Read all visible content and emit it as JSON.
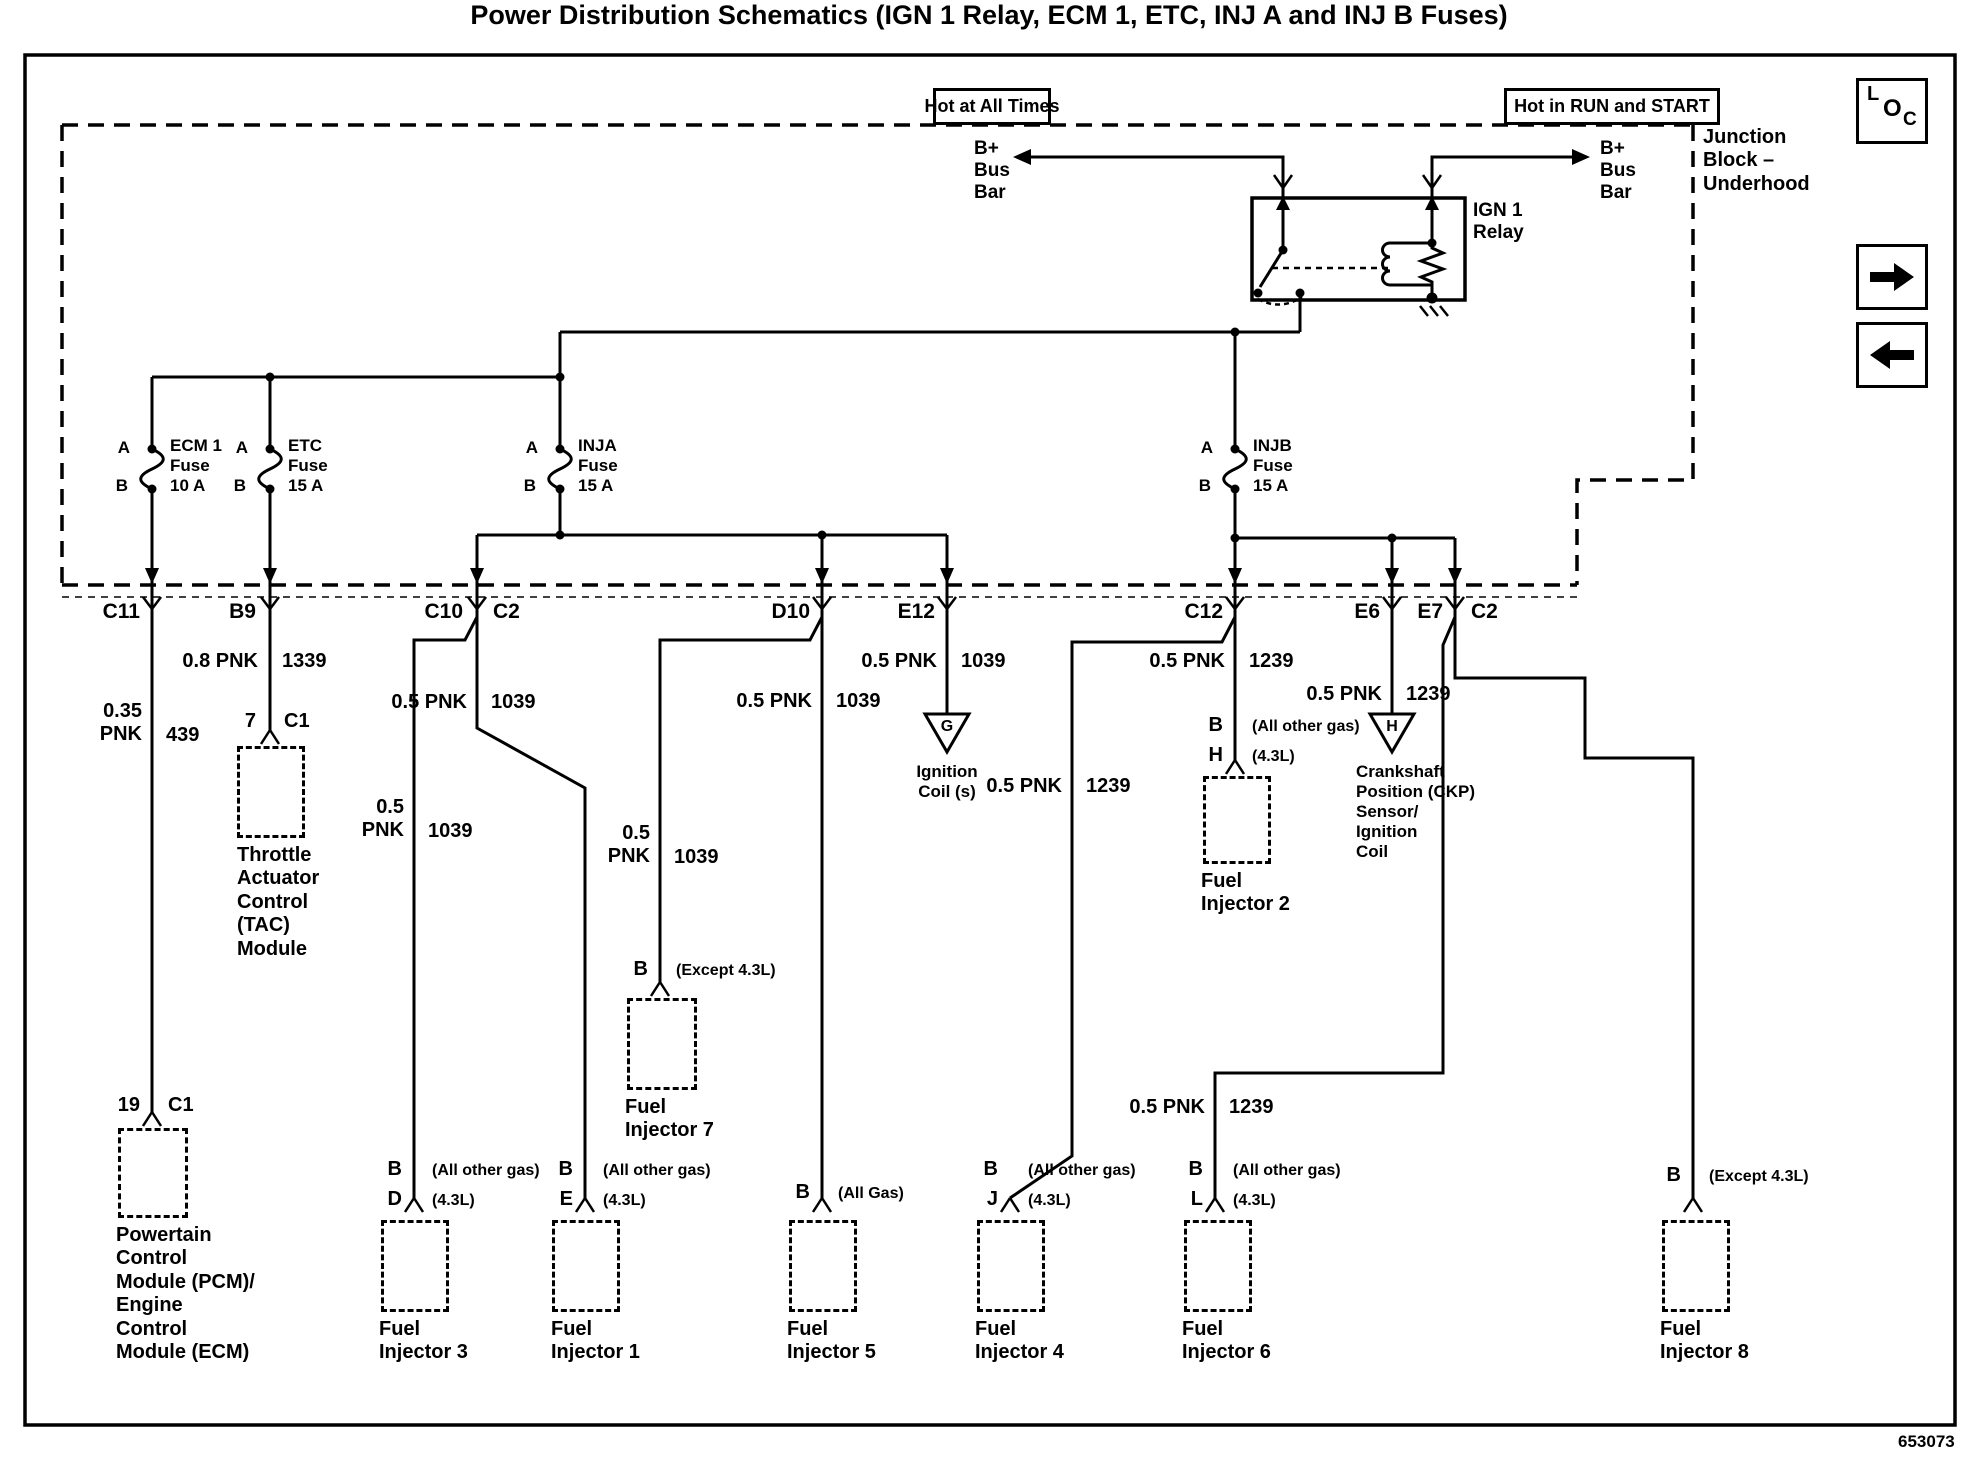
{
  "title": "Power Distribution Schematics (IGN 1 Relay, ECM 1, ETC, INJ A and INJ B Fuses)",
  "doc_number": "653073",
  "banners": {
    "left": "Hot at All Times",
    "right": "Hot in RUN and START"
  },
  "junction_block": {
    "label": "Junction\nBlock –\nUnderhood"
  },
  "loc_icon": {
    "l": "L",
    "o": "O",
    "c": "C"
  },
  "bus_bar_left": "B+\nBus\nBar",
  "bus_bar_right": "B+\nBus\nBar",
  "relay_label": "IGN 1\nRelay",
  "fuses": [
    {
      "pin_top": "A",
      "pin_bottom": "B",
      "name": "ECM 1\nFuse\n10 A"
    },
    {
      "pin_top": "A",
      "pin_bottom": "B",
      "name": "ETC\nFuse\n15 A"
    },
    {
      "pin_top": "A",
      "pin_bottom": "B",
      "name": "INJA\nFuse\n15 A"
    },
    {
      "pin_top": "A",
      "pin_bottom": "B",
      "name": "INJB\nFuse\n15 A"
    }
  ],
  "connectors": {
    "c11": "C11",
    "b9": "B9",
    "c10": "C10",
    "c10_right": "C2",
    "d10": "D10",
    "e12": "E12",
    "c12": "C12",
    "e6": "E6",
    "e7": "E7",
    "e7_right": "C2"
  },
  "wires": {
    "c11": {
      "gauge": "0.35\nPNK",
      "circuit": "439"
    },
    "b9": {
      "gauge": "0.8 PNK",
      "circuit": "1339"
    },
    "c2_main": {
      "gauge": "0.5 PNK",
      "circuit": "1039"
    },
    "fi3": {
      "gauge": "0.5\nPNK",
      "circuit": "1039"
    },
    "fi7": {
      "gauge": "0.5\nPNK",
      "circuit": "1039"
    },
    "d10": {
      "gauge": "0.5 PNK",
      "circuit": "1039"
    },
    "e12": {
      "gauge": "0.5 PNK",
      "circuit": "1039"
    },
    "c12": {
      "gauge": "0.5 PNK",
      "circuit": "1239"
    },
    "fi4": {
      "gauge": "0.5 PNK",
      "circuit": "1239"
    },
    "e6": {
      "gauge": "0.5 PNK",
      "circuit": "1239"
    },
    "fi6": {
      "gauge": "0.5 PNK",
      "circuit": "1239"
    }
  },
  "devices": {
    "tac": {
      "pin": "7",
      "conn": "C1",
      "name": "Throttle\nActuator\nControl\n(TAC)\nModule"
    },
    "pcm": {
      "pin": "19",
      "conn": "C1",
      "name": "Powertain\nControl\nModule (PCM)/\nEngine\nControl\nModule (ECM)"
    },
    "ign_coil": {
      "letter": "G",
      "name": "Ignition\nCoil (s)"
    },
    "ckp": {
      "letter": "H",
      "name": "Crankshaft\nPosition (CKP)\nSensor/\nIgnition\nCoil"
    },
    "fi1": {
      "pin1": "B",
      "qual1": "(All other gas)",
      "pin2": "E",
      "qual2": "(4.3L)",
      "name": "Fuel\nInjector 1"
    },
    "fi2": {
      "pin1": "B",
      "qual1": "(All other gas)",
      "pin2": "H",
      "qual2": "(4.3L)",
      "name": "Fuel\nInjector 2"
    },
    "fi3": {
      "pin1": "B",
      "qual1": "(All other gas)",
      "pin2": "D",
      "qual2": "(4.3L)",
      "name": "Fuel\nInjector 3"
    },
    "fi4": {
      "pin1": "B",
      "qual1": "(All other gas)",
      "pin2": "J",
      "qual2": "(4.3L)",
      "name": "Fuel\nInjector 4"
    },
    "fi5": {
      "pin1": "B",
      "qual1": "(All Gas)",
      "name": "Fuel\nInjector 5"
    },
    "fi6": {
      "pin1": "B",
      "qual1": "(All other gas)",
      "pin2": "L",
      "qual2": "(4.3L)",
      "name": "Fuel\nInjector 6"
    },
    "fi7": {
      "pin1": "B",
      "qual1": "(Except 4.3L)",
      "name": "Fuel\nInjector 7"
    },
    "fi8": {
      "pin1": "B",
      "qual1": "(Except 4.3L)",
      "name": "Fuel\nInjector 8"
    }
  }
}
